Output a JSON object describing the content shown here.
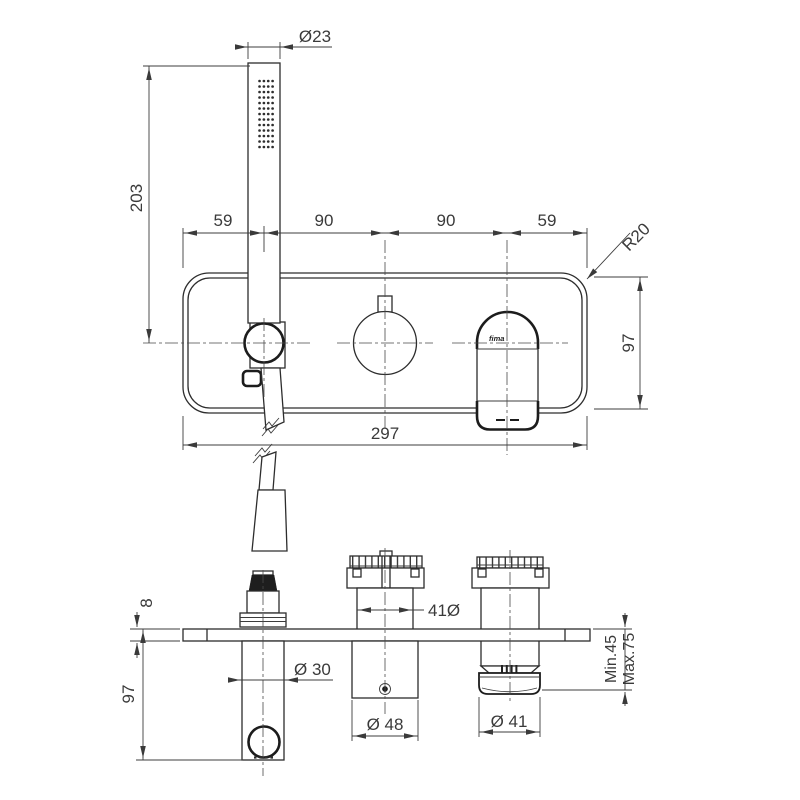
{
  "front_view": {
    "dim_handshower_diameter": "Ø23",
    "dim_handshower_height": "203",
    "dim_spacing_1": "59",
    "dim_spacing_2": "90",
    "dim_spacing_3": "90",
    "dim_spacing_4": "59",
    "dim_corner_radius": "R20",
    "dim_plate_height": "97",
    "dim_plate_width": "297",
    "brand_label": "fima"
  },
  "side_view": {
    "dim_plate_thickness": "8",
    "dim_body_height": "97",
    "dim_spout_diameter": "Ø 30",
    "dim_valve_body_diameter": "41Ø",
    "dim_knob_diameter": "Ø 48",
    "dim_handle_diameter": "Ø 41",
    "dim_depth_min": "Min.45",
    "dim_depth_max": "Max.75"
  }
}
